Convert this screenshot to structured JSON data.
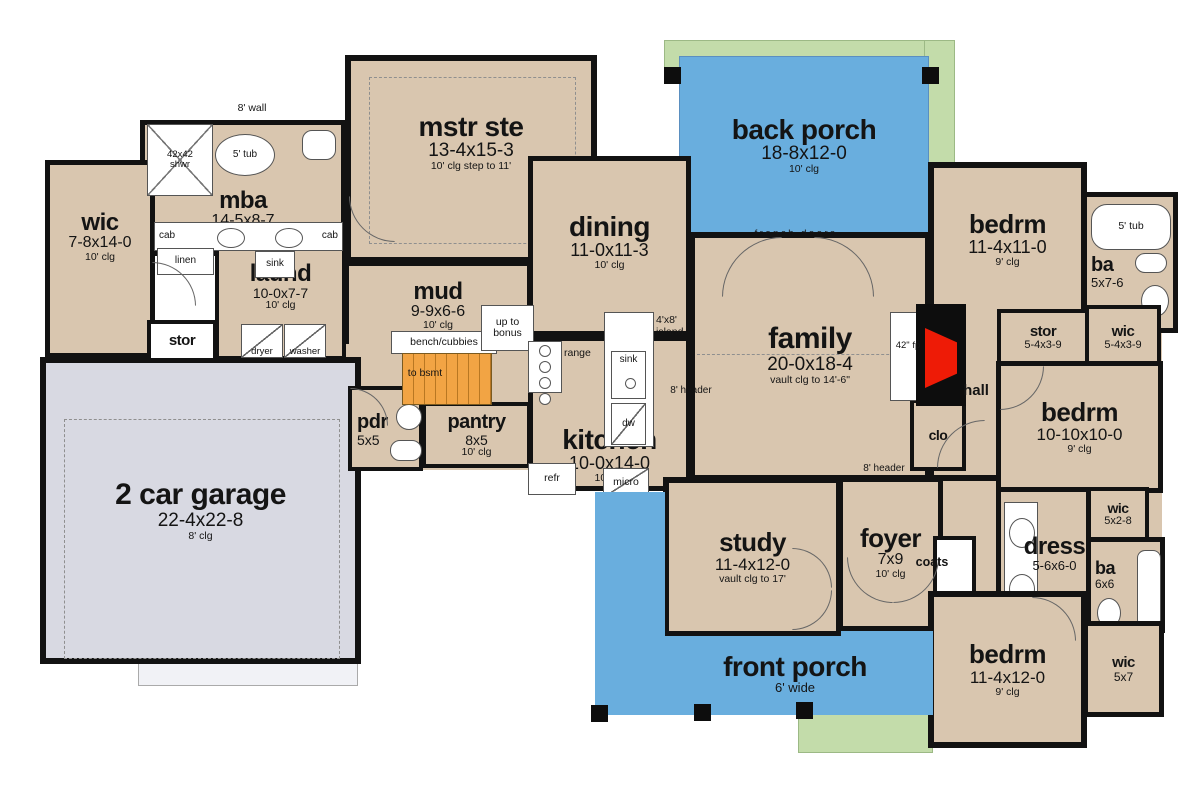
{
  "rooms": {
    "mstr_ste": {
      "name": "mstr ste",
      "dims": "13-4x15-3",
      "clg": "10' clg step to 11'"
    },
    "mba": {
      "name": "mba",
      "dims": "14-5x8-7",
      "clg": "10' clg"
    },
    "wic_master": {
      "name": "wic",
      "dims": "7-8x14-0",
      "clg": "10' clg"
    },
    "laund": {
      "name": "laund",
      "dims": "10-0x7-7",
      "clg": "10' clg"
    },
    "stor_left": {
      "name": "stor"
    },
    "mud": {
      "name": "mud",
      "dims": "9-9x6-6",
      "clg": "10' clg"
    },
    "pantry": {
      "name": "pantry",
      "dims": "8x5",
      "clg": "10' clg"
    },
    "pdr": {
      "name": "pdr",
      "dims": "5x5"
    },
    "dining": {
      "name": "dining",
      "dims": "11-0x11-3",
      "clg": "10' clg"
    },
    "kitchen": {
      "name": "kitchen",
      "dims": "10-0x14-0",
      "clg": "10' clg"
    },
    "family": {
      "name": "family",
      "dims": "20-0x18-4",
      "clg": "vault clg to 14'-6\""
    },
    "back_porch": {
      "name": "back porch",
      "dims": "18-8x12-0",
      "clg": "10' clg"
    },
    "front_porch": {
      "name": "front porch",
      "dims": "6' wide"
    },
    "garage": {
      "name": "2 car garage",
      "dims": "22-4x22-8",
      "clg": "8' clg"
    },
    "study": {
      "name": "study",
      "dims": "11-4x12-0",
      "clg": "vault clg to 17'"
    },
    "foyer": {
      "name": "foyer",
      "dims": "7x9",
      "clg": "10' clg"
    },
    "bedrm_ne": {
      "name": "bedrm",
      "dims": "11-4x11-0",
      "clg": "9' clg"
    },
    "ba_ne": {
      "name": "ba",
      "dims": "5x7-6"
    },
    "wic_ne": {
      "name": "wic",
      "dims": "5-4x3-9"
    },
    "stor_hall": {
      "name": "stor",
      "dims": "5-4x3-9"
    },
    "hall": {
      "name": "hall"
    },
    "clo": {
      "name": "clo"
    },
    "bedrm_e": {
      "name": "bedrm",
      "dims": "10-10x10-0",
      "clg": "9' clg"
    },
    "dress": {
      "name": "dress",
      "dims": "5-6x6-0"
    },
    "wic_e": {
      "name": "wic",
      "dims": "5x2-8"
    },
    "ba_e": {
      "name": "ba",
      "dims": "6x6"
    },
    "bedrm_se": {
      "name": "bedrm",
      "dims": "11-4x12-0",
      "clg": "9' clg"
    },
    "wic_se": {
      "name": "wic",
      "dims": "5x7"
    },
    "coats": {
      "name": "coats"
    }
  },
  "fixtures": {
    "wall_note": "8' wall",
    "shwr": "42x42 shwr",
    "tub_mba": "5' tub",
    "cab_l": "cab",
    "cab_r": "cab",
    "linen": "linen",
    "sink_mba": "sink",
    "dryer": "dryer",
    "washer": "washer",
    "bench": "bench/cubbies",
    "to_bsmt": "to bsmt",
    "up_to_bonus": "up to bonus",
    "range": "range",
    "island_note": "4'x8' island",
    "sink_kitchen": "sink",
    "dw": "dw",
    "refr": "refr",
    "micro": "micro",
    "header_w": "8' header",
    "header_s": "8' header",
    "french_doors": "french doors",
    "fp": "42\" fp",
    "tub_ne": "5' tub"
  },
  "colors": {
    "floor": "#d9c6af",
    "garage": "#d8d9e2",
    "porch": "#69aede",
    "lawn": "#c3dcaa",
    "stairs": "#f2a444",
    "fireplace": "#ee1b06",
    "wall": "#121212"
  }
}
